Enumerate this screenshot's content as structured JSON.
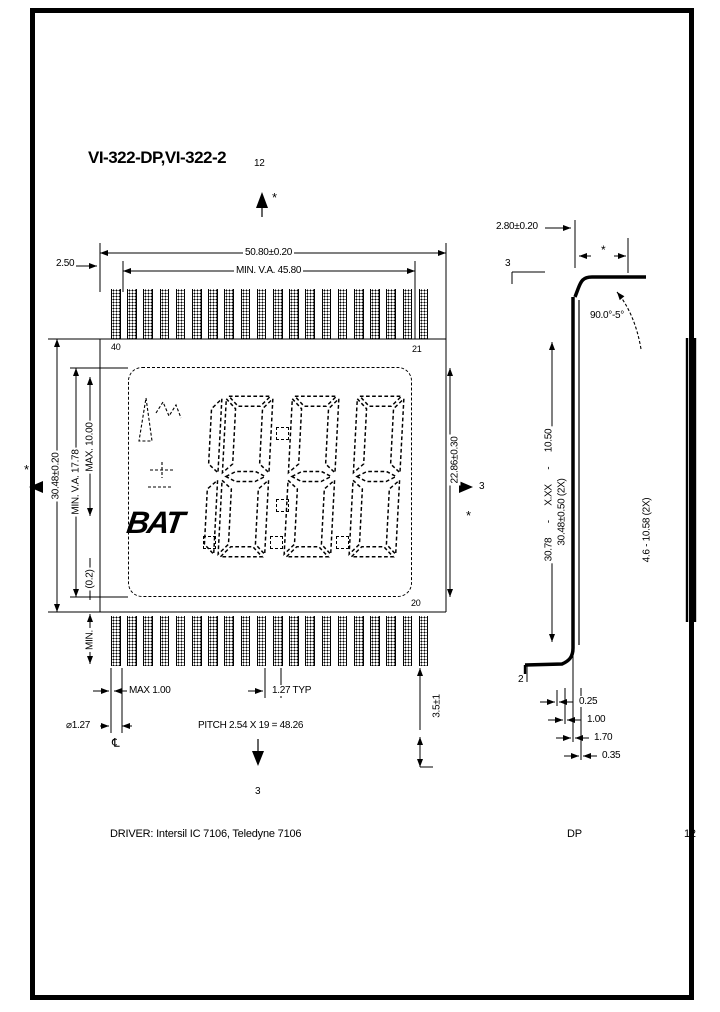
{
  "title": "VI-322-DP,VI-322-2",
  "marks": {
    "top_number": "12",
    "top_star": "*",
    "bottom_number": "3",
    "left_star": "*",
    "right_number": "3",
    "right_star": "*"
  },
  "front_view": {
    "dim_overall_width": "50.80±0.20",
    "dim_va_width": "MIN. V.A. 45.80",
    "dim_end_margin": "2.50",
    "dim_overall_height": "30.48±0.20",
    "dim_va_height": "MIN. V.A. 17.78",
    "dim_max_height": "MAX. 10.00",
    "dim_paren": "(0.2)",
    "dim_min": "MIN.",
    "dim_digit_height": "22.86±0.30",
    "pin_top_left_no": "40",
    "pin_top_right_no": "21",
    "pin_bottom_right_no": "20",
    "centerline_symbol": "℄",
    "dim_pin_width_max": "MAX 1.00",
    "dim_pin_dia": "⌀1.27",
    "dim_pin_pitch_typ": "1.27 TYP",
    "dim_pitch_total": "PITCH 2.54 X 19 = 48.26",
    "dim_pin_length": "3.5±1",
    "pins_per_row": 20,
    "lcd": {
      "bat_label": "BAT",
      "digits": [
        {
          "char": "1",
          "segs": "bc"
        },
        {
          "char": "8",
          "segs": "abcdefg"
        },
        {
          "char": "8",
          "segs": "abcdefg"
        },
        {
          "char": "8",
          "segs": "abcdefg"
        }
      ]
    }
  },
  "side_view": {
    "dim_thickness": "2.80±0.20",
    "dim_star": "*",
    "dim_bend_angle": "90.0°-5°",
    "datum_top": "3",
    "datum_bottom": "2",
    "dim_height_with_pins": "30.78 - X.XX - 10.50",
    "dim_glass_height": "30.48±0.50 (2X)",
    "dim_right": "4.6 - 10.58 (2X)",
    "dim_detail_1": "0.25",
    "dim_detail_2": "1.00",
    "dim_detail_3": "1.70",
    "dim_detail_4": "0.35"
  },
  "footer": {
    "driver_note": "DRIVER: Intersil IC 7106, Teledyne 7106",
    "type_label": "DP",
    "page_number": "12"
  }
}
